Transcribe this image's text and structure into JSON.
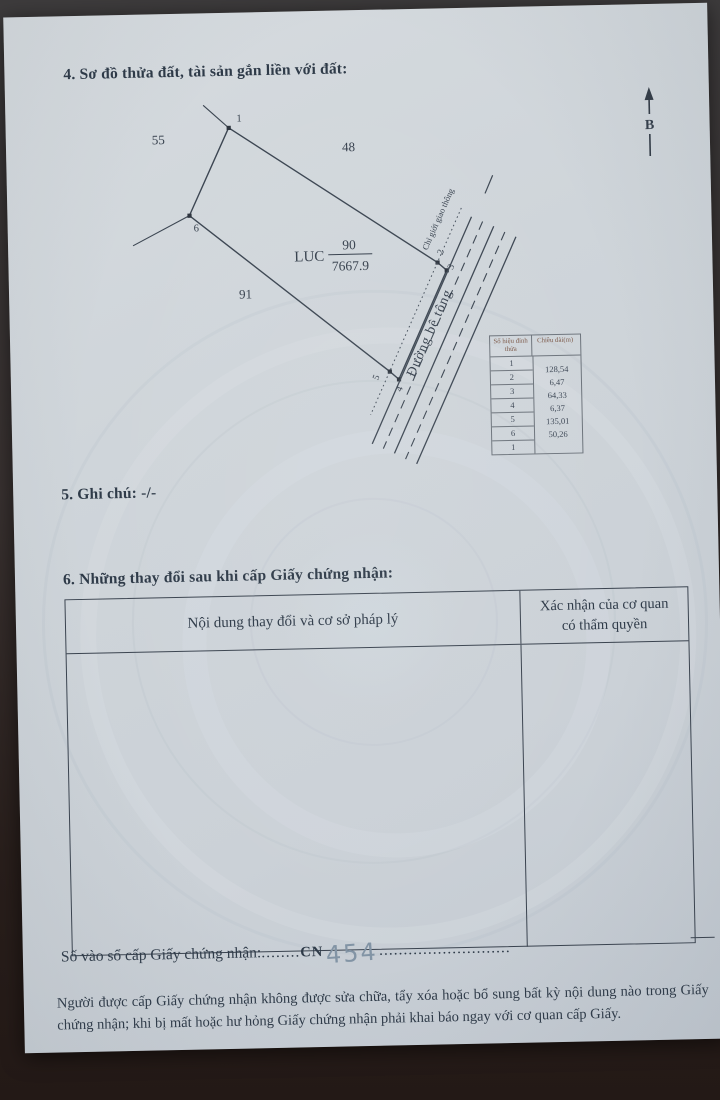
{
  "document": {
    "section4_title": "4. Sơ đồ thửa đất, tài sản gắn liền với đất:",
    "section5_title": "5. Ghi chú: -/-",
    "section6_title": "6. Những thay đổi sau khi cấp Giấy chứng nhận:",
    "register_label": "Số vào sổ cấp Giấy chứng nhận:",
    "register_dots_left": "........",
    "register_code": "CN",
    "register_number": "454",
    "register_dots_right": "...........................",
    "footer_note": "Người được cấp Giấy chứng nhận không được sửa chữa, tẩy xóa hoặc bổ sung bất kỳ nội dung nào trong Giấy chứng nhận; khi bị mất hoặc hư hỏng Giấy chứng nhận phải khai báo ngay với cơ quan cấp Giấy."
  },
  "diagram": {
    "north_label": "B",
    "parcel": {
      "land_use": "LUC",
      "number": "90",
      "area": "7667.9"
    },
    "adjacent_parcels": {
      "left": "55",
      "top": "48",
      "bottom": "91"
    },
    "vertex_labels": [
      "1",
      "2",
      "3",
      "4",
      "5",
      "6"
    ],
    "road_label": "Đường bê tông",
    "boundary_label": "Chỉ giới giao thông"
  },
  "measurement_table": {
    "headers": {
      "col1": "Số hiệu đỉnh thửa",
      "col2": "Chiều dài(m)"
    },
    "vertices": [
      "1",
      "2",
      "3",
      "4",
      "5",
      "6",
      "1"
    ],
    "lengths": [
      "128,54",
      "6,47",
      "64,33",
      "6,37",
      "135,01",
      "50,26"
    ]
  },
  "changes_table": {
    "col1_header": "Nội dung thay đổi và cơ sở pháp lý",
    "col2_header": "Xác nhận của cơ quan có thẩm quyền"
  }
}
